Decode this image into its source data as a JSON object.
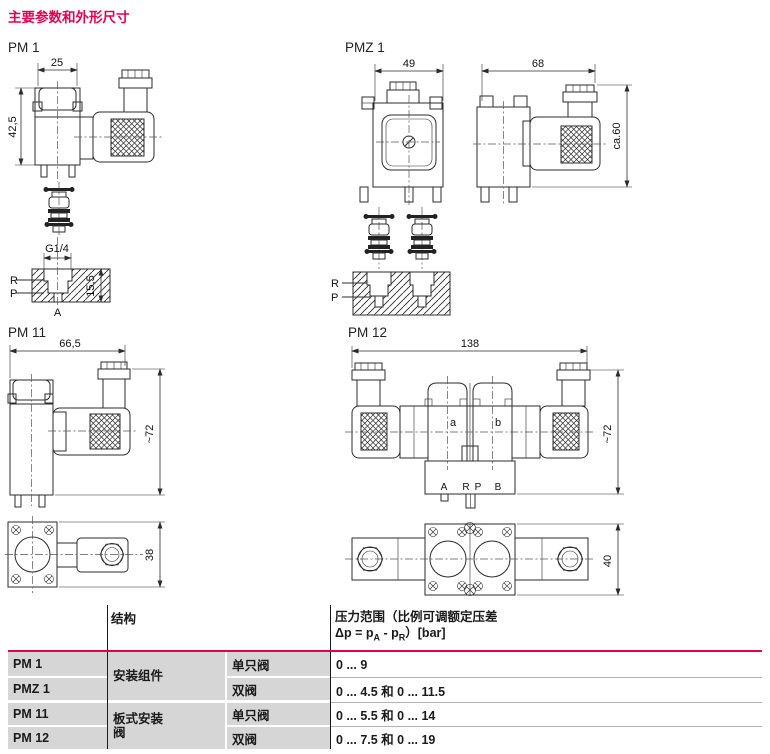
{
  "title": "主要参数和外形尺寸",
  "drawings": {
    "pm1": {
      "label": "PM 1",
      "dim_width": "25",
      "dim_height": "42,5",
      "thread": "G1/4",
      "dim_depth": "15,5",
      "port_r": "R",
      "port_p": "P",
      "port_a": "A"
    },
    "pmz1": {
      "label": "PMZ 1",
      "dim_front_width": "49",
      "dim_side_width": "68",
      "dim_height": "ca.60",
      "port_r": "R",
      "port_p": "P"
    },
    "pm11": {
      "label": "PM 11",
      "dim_width": "66,5",
      "dim_height": "~72",
      "dim_bottom": "38"
    },
    "pm12": {
      "label": "PM 12",
      "dim_width": "138",
      "dim_height": "~72",
      "dim_bottom": "40",
      "valve_a": "a",
      "valve_b": "b",
      "port_a": "A",
      "port_r": "R",
      "port_p": "P",
      "port_b": "B"
    }
  },
  "table": {
    "col_structure": "结构",
    "pressure_header": {
      "line1": "压力范围（比例可调额定压差",
      "dp_prefix": "Δp = p",
      "sub_a": "A",
      "mid": " - p",
      "sub_r": "R",
      "suffix": "）[bar]"
    },
    "groups": [
      {
        "line1": "安装组件",
        "line2": ""
      },
      {
        "line1": "板式安装",
        "line2": "阀"
      }
    ],
    "rows": [
      {
        "model": "PM 1",
        "config": "单只阀",
        "pressure": "0 ... 9"
      },
      {
        "model": "PMZ 1",
        "config": "双阀",
        "pressure": "0 ... 4.5 和 0 ... 11.5"
      },
      {
        "model": "PM 11",
        "config": "单只阀",
        "pressure": "0 ... 5.5 和 0 ... 14"
      },
      {
        "model": "PM 12",
        "config": "双阀",
        "pressure": "0 ... 7.5 和 0 ... 19"
      }
    ]
  }
}
